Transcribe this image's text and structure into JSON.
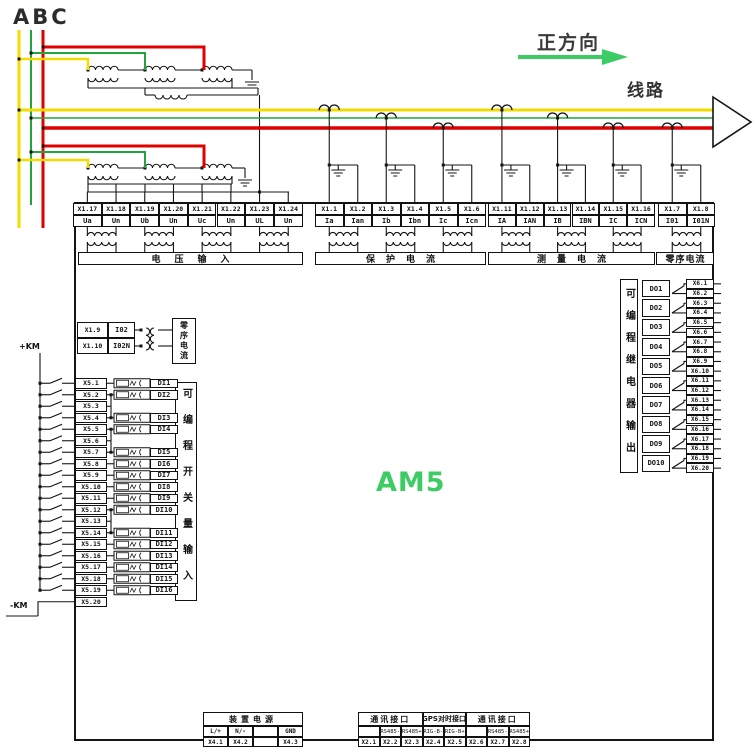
{
  "meta": {
    "device_label": "AM5",
    "accent_green": "#3dcb63",
    "phase_colors": {
      "a": "#f2dc00",
      "b": "#23a33f",
      "c": "#df0000"
    }
  },
  "top": {
    "phase_label": "ABC",
    "direction_label": "正方向",
    "line_label": "线路"
  },
  "terminal_strip": {
    "groups": [
      {
        "name": "voltage-input",
        "label": "电压输入",
        "terminals": [
          {
            "id": "X1.17",
            "signal": "Ua"
          },
          {
            "id": "X1.18",
            "signal": "Un"
          },
          {
            "id": "X1.19",
            "signal": "Ub"
          },
          {
            "id": "X1.20",
            "signal": "Un"
          },
          {
            "id": "X1.21",
            "signal": "Uc"
          },
          {
            "id": "X1.22",
            "signal": "Un"
          },
          {
            "id": "X1.23",
            "signal": "UL"
          },
          {
            "id": "X1.24",
            "signal": "Un"
          }
        ]
      },
      {
        "name": "protection-current",
        "label": "保护电流",
        "terminals": [
          {
            "id": "X1.1",
            "signal": "Ia"
          },
          {
            "id": "X1.2",
            "signal": "Ian"
          },
          {
            "id": "X1.3",
            "signal": "Ib"
          },
          {
            "id": "X1.4",
            "signal": "Ibn"
          },
          {
            "id": "X1.5",
            "signal": "Ic"
          },
          {
            "id": "X1.6",
            "signal": "Icn"
          }
        ]
      },
      {
        "name": "measure-current",
        "label": "测量电流",
        "terminals": [
          {
            "id": "X1.11",
            "signal": "IA"
          },
          {
            "id": "X1.12",
            "signal": "IAN"
          },
          {
            "id": "X1.13",
            "signal": "IB"
          },
          {
            "id": "X1.14",
            "signal": "IBN"
          },
          {
            "id": "X1.15",
            "signal": "IC"
          },
          {
            "id": "X1.16",
            "signal": "ICN"
          }
        ]
      },
      {
        "name": "zero-seq-current",
        "label": "零序电流",
        "terminals": [
          {
            "id": "X1.7",
            "signal": "I01"
          },
          {
            "id": "X1.8",
            "signal": "I01N"
          }
        ]
      }
    ]
  },
  "zero_seq_block": {
    "label": "零序电流",
    "rows": [
      {
        "id": "X1.9",
        "signal": "I02"
      },
      {
        "id": "X1.10",
        "signal": "I02N"
      }
    ]
  },
  "digital_inputs": {
    "label": "可编程开关量输入",
    "bus_plus": "+KM",
    "bus_minus": "-KM",
    "rows": [
      {
        "terminal": "X5.1",
        "di": "DI1"
      },
      {
        "terminal": "X5.2",
        "di": "DI2"
      },
      {
        "terminal": "X5.3",
        "di": ""
      },
      {
        "terminal": "X5.4",
        "di": "DI3"
      },
      {
        "terminal": "X5.5",
        "di": "DI4"
      },
      {
        "terminal": "X5.6",
        "di": ""
      },
      {
        "terminal": "X5.7",
        "di": "DI5"
      },
      {
        "terminal": "X5.8",
        "di": "DI6"
      },
      {
        "terminal": "X5.9",
        "di": "DI7"
      },
      {
        "terminal": "X5.10",
        "di": "DI8"
      },
      {
        "terminal": "X5.11",
        "di": "DI9"
      },
      {
        "terminal": "X5.12",
        "di": "DI10"
      },
      {
        "terminal": "X5.13",
        "di": ""
      },
      {
        "terminal": "X5.14",
        "di": "DI11"
      },
      {
        "terminal": "X5.15",
        "di": "DI12"
      },
      {
        "terminal": "X5.16",
        "di": "DI13"
      },
      {
        "terminal": "X5.17",
        "di": "DI14"
      },
      {
        "terminal": "X5.18",
        "di": "DI15"
      },
      {
        "terminal": "X5.19",
        "di": "DI16"
      },
      {
        "terminal": "X5.20",
        "di": ""
      }
    ]
  },
  "relay_outputs": {
    "label": "可编程继电器输出",
    "rows": [
      {
        "do": "DO1",
        "terminals": [
          "X6.1",
          "X6.2"
        ]
      },
      {
        "do": "DO2",
        "terminals": [
          "X6.3",
          "X6.4"
        ]
      },
      {
        "do": "DO3",
        "terminals": [
          "X6.5",
          "X6.6"
        ]
      },
      {
        "do": "DO4",
        "terminals": [
          "X6.7",
          "X6.8"
        ]
      },
      {
        "do": "DO5",
        "terminals": [
          "X6.9",
          "X6.10"
        ]
      },
      {
        "do": "DO6",
        "terminals": [
          "X6.11",
          "X6.12"
        ]
      },
      {
        "do": "DO7",
        "terminals": [
          "X6.13",
          "X6.14"
        ]
      },
      {
        "do": "DO8",
        "terminals": [
          "X6.15",
          "X6.16"
        ]
      },
      {
        "do": "DO9",
        "terminals": [
          "X6.17",
          "X6.18"
        ]
      },
      {
        "do": "DO10",
        "terminals": [
          "X6.19",
          "X6.20"
        ]
      }
    ]
  },
  "bottom": {
    "power": {
      "title": "装置电源",
      "columns": [
        {
          "signal": "L/+",
          "terminal": "X4.1"
        },
        {
          "signal": "N/-",
          "terminal": "X4.2"
        },
        {
          "signal": "",
          "terminal": ""
        },
        {
          "signal": "GND",
          "terminal": "X4.3"
        }
      ]
    },
    "comm": {
      "sections": [
        {
          "title": "通讯接口",
          "span": 3
        },
        {
          "title": "GPS对时接口",
          "span": 2
        },
        {
          "title": "通讯接口",
          "span": 3
        }
      ],
      "columns": [
        {
          "signal": "",
          "terminal": "X2.1"
        },
        {
          "signal": "RS485-",
          "terminal": "X2.2"
        },
        {
          "signal": "RS485+",
          "terminal": "X2.3"
        },
        {
          "signal": "RIG-B-",
          "terminal": "X2.4"
        },
        {
          "signal": "RIG-B+",
          "terminal": "X2.5"
        },
        {
          "signal": "",
          "terminal": "X2.6"
        },
        {
          "signal": "RS485-",
          "terminal": "X2.7"
        },
        {
          "signal": "RS485+",
          "terminal": "X2.8"
        }
      ]
    }
  }
}
